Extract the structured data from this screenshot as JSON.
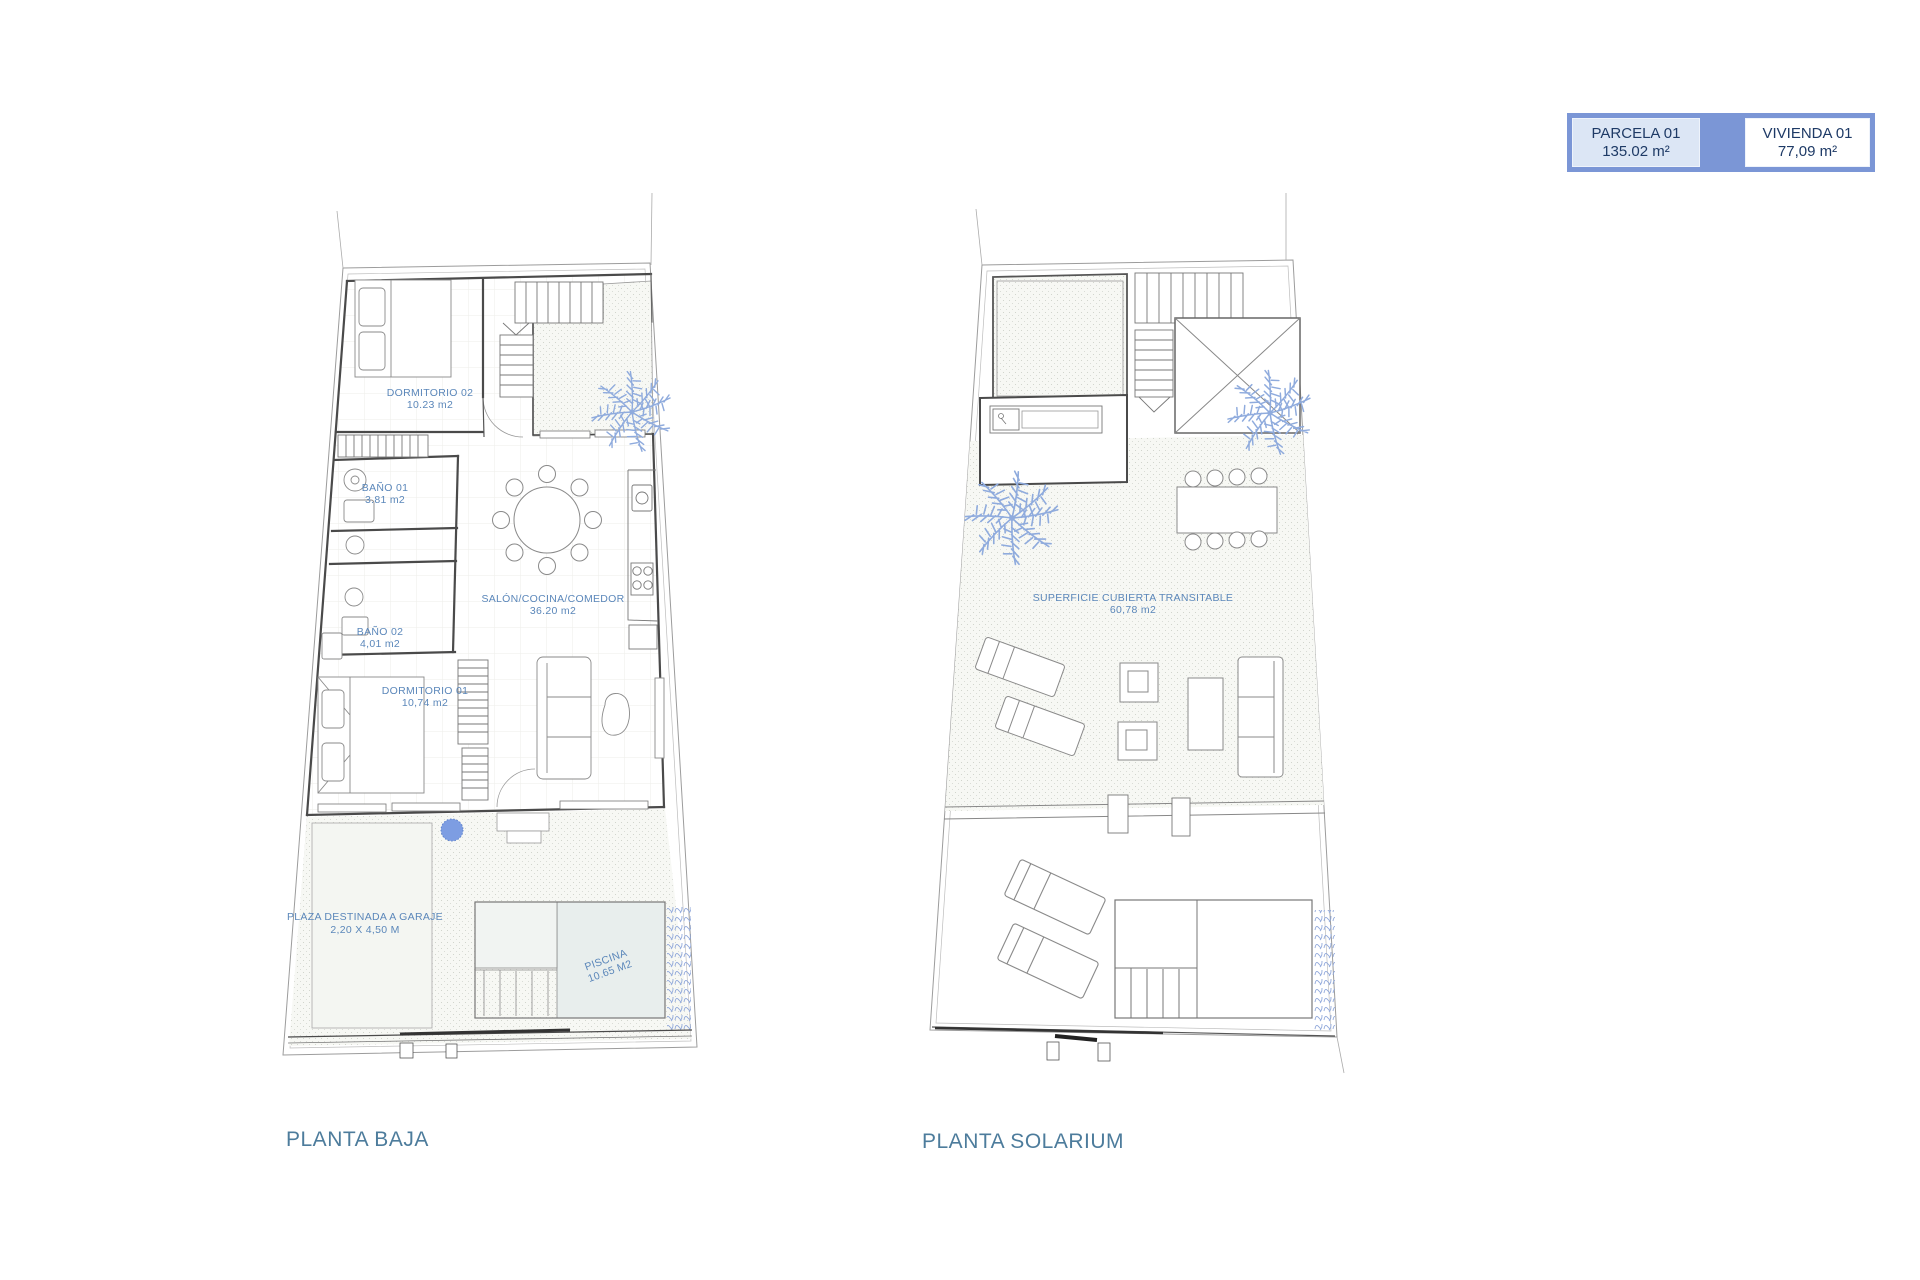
{
  "sheet": {
    "background": "#ffffff"
  },
  "legend": {
    "parcela_label": "PARCELA 01",
    "parcela_value": "135.02 m²",
    "vivienda_label": "VIVIENDA 01",
    "vivienda_value": "77,09 m²"
  },
  "plans": {
    "planta_baja": {
      "title": "PLANTA BAJA",
      "rooms": {
        "dormitorio_02": {
          "name": "DORMITORIO 02",
          "area": "10.23 m2"
        },
        "bano_01": {
          "name": "BAÑO 01",
          "area": "3.81 m2"
        },
        "bano_02": {
          "name": "BAÑO 02",
          "area": "4,01 m2"
        },
        "dormitorio_01": {
          "name": "DORMITORIO 01",
          "area": "10,74 m2"
        },
        "salon": {
          "name": "SALÓN/COCINA/COMEDOR",
          "area": "36.20 m2"
        },
        "garaje": {
          "name": "PLAZA DESTINADA A GARAJE",
          "area": "2,20 X 4,50 M"
        },
        "piscina": {
          "name": "PISCINA",
          "area": "10.65 M2"
        }
      }
    },
    "planta_solarium": {
      "title": "PLANTA SOLARIUM",
      "rooms": {
        "superficie": {
          "name": "SUPERFICIE CUBIERTA TRANSITABLE",
          "area": "60,78 m2"
        }
      }
    }
  },
  "colors": {
    "accent_blue": "#7b96d6",
    "legend_cell_blue": "#dce6f5",
    "legend_text_navy": "#1e3a66",
    "room_label_blue": "#5b87ba",
    "title_blue": "#4d7c9c",
    "palm_blue": "#8fabdd",
    "pool_water": "#e8eeed"
  }
}
